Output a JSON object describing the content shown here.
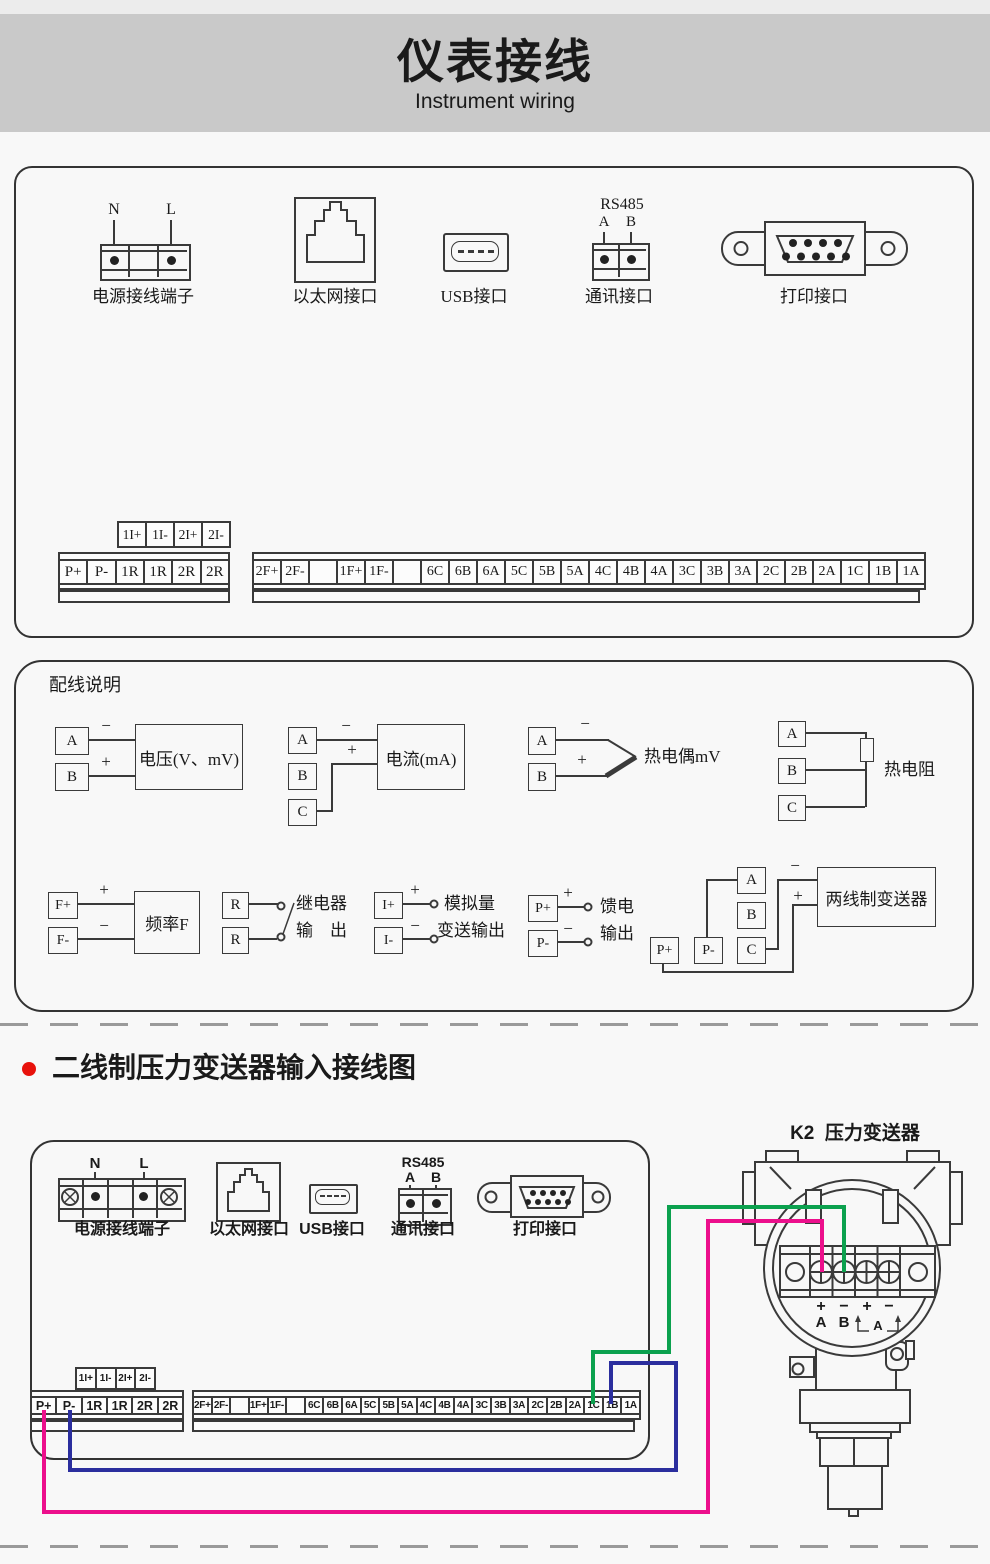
{
  "header": {
    "title": "仪表接线",
    "subtitle": "Instrument wiring"
  },
  "top_panel": {
    "power": {
      "label": "电源接线端子",
      "pin1": "N",
      "pin2": "L"
    },
    "ethernet": {
      "label": "以太网接口"
    },
    "usb": {
      "label": "USB接口"
    },
    "comm": {
      "label": "通讯接口",
      "protocol": "RS485",
      "pin1": "A",
      "pin2": "B"
    },
    "printer": {
      "label": "打印接口"
    },
    "aux_strip": [
      "1I+",
      "1I-",
      "2I+",
      "2I-"
    ],
    "left_strip": [
      "P+",
      "P-",
      "1R",
      "1R",
      "2R",
      "2R"
    ],
    "right_strip": [
      "2F+",
      "2F-",
      "",
      "1F+",
      "1F-",
      "",
      "6C",
      "6B",
      "6A",
      "5C",
      "5B",
      "5A",
      "4C",
      "4B",
      "4A",
      "3C",
      "3B",
      "3A",
      "2C",
      "2B",
      "2A",
      "1C",
      "1B",
      "1A"
    ]
  },
  "wiring_panel": {
    "title": "配线说明",
    "voltage": {
      "t1": "A",
      "t2": "B",
      "s1": "−",
      "s2": "+",
      "label": "电压(V、mV)"
    },
    "current": {
      "t1": "A",
      "t2": "B",
      "t3": "C",
      "s1": "−",
      "s2": "+",
      "label": "电流(mA)"
    },
    "thermocouple": {
      "t1": "A",
      "t2": "B",
      "s1": "−",
      "s2": "+",
      "label": "热电偶mV"
    },
    "rtd": {
      "t1": "A",
      "t2": "B",
      "t3": "C",
      "label": "热电阻"
    },
    "frequency": {
      "t1": "F+",
      "t2": "F-",
      "s1": "+",
      "s2": "−",
      "label": "频率F"
    },
    "relay": {
      "t1": "R",
      "t2": "R",
      "label1": "继电器",
      "label2": "输　出"
    },
    "analog": {
      "t1": "I+",
      "t2": "I-",
      "s1": "+",
      "s2": "−",
      "label1": "模拟量",
      "label2": "变送输出"
    },
    "feed": {
      "t1": "P+",
      "t2": "P-",
      "s1": "+",
      "s2": "−",
      "label1": "馈电",
      "label2": "输出"
    },
    "two_wire": {
      "tp1": "P+",
      "tp2": "P-",
      "ta": "A",
      "tb": "B",
      "tc": "C",
      "s1": "−",
      "s2": "+",
      "label": "两线制变送器"
    }
  },
  "section2": {
    "bullet_color": "#e8120c",
    "title": "二线制压力变送器输入接线图",
    "panel": {
      "power": {
        "label": "电源接线端子",
        "pin1": "N",
        "pin2": "L"
      },
      "ethernet": {
        "label": "以太网接口"
      },
      "usb": {
        "label": "USB接口"
      },
      "comm": {
        "label": "通讯接口",
        "protocol": "RS485",
        "pin1": "A",
        "pin2": "B"
      },
      "printer": {
        "label": "打印接口"
      },
      "aux_strip": [
        "1I+",
        "1I-",
        "2I+",
        "2I-"
      ],
      "left_strip": [
        "P+",
        "P-",
        "1R",
        "1R",
        "2R",
        "2R"
      ],
      "right_strip": [
        "2F+",
        "2F-",
        "",
        "1F+",
        "1F-",
        "",
        "6C",
        "6B",
        "6A",
        "5C",
        "5B",
        "5A",
        "4C",
        "4B",
        "4A",
        "3C",
        "3B",
        "3A",
        "2C",
        "2B",
        "2A",
        "1C",
        "1B",
        "1A"
      ]
    },
    "k2": {
      "title": "K2  压力变送器",
      "s1": "+",
      "s2": "−",
      "s3": "+",
      "s4": "−",
      "pinA": "A",
      "pinB": "B",
      "bracket": "A"
    },
    "wire_colors": {
      "pink": "#ec0f8c",
      "blue": "#2b2e9e",
      "green": "#0ba14e"
    }
  }
}
